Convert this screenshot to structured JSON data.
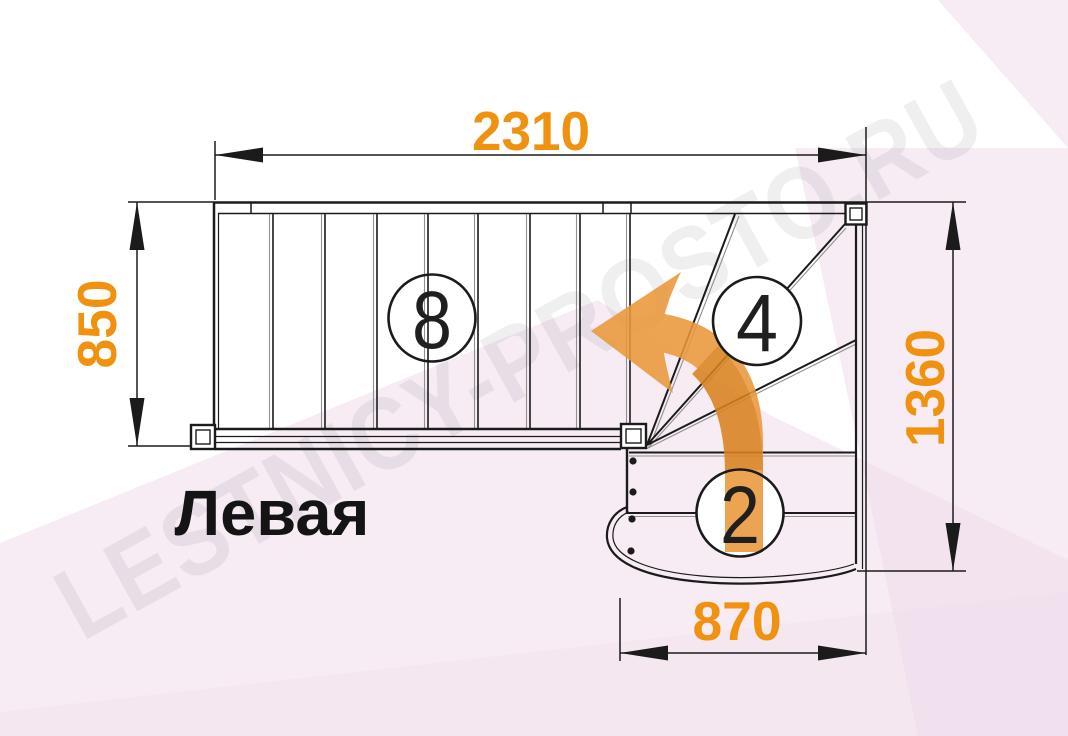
{
  "drawing": {
    "title_label": "Левая",
    "watermark": "LESTNICY-PROSTO.RU",
    "dimensions": {
      "top_width": "2310",
      "left_depth": "850",
      "right_height": "1360",
      "bottom_width": "870"
    },
    "step_counts": {
      "upper_flight": "8",
      "winders": "4",
      "lower_flight": "2"
    },
    "colors": {
      "line": "#1b1b1b",
      "line_secondary": "#909090",
      "dimension_text": "#F0920F",
      "arrow_light": "#EA983B",
      "arrow_dark": "#D9831F",
      "background_tint": "#EFD9E9",
      "watermark_text": "#4a4350"
    }
  }
}
